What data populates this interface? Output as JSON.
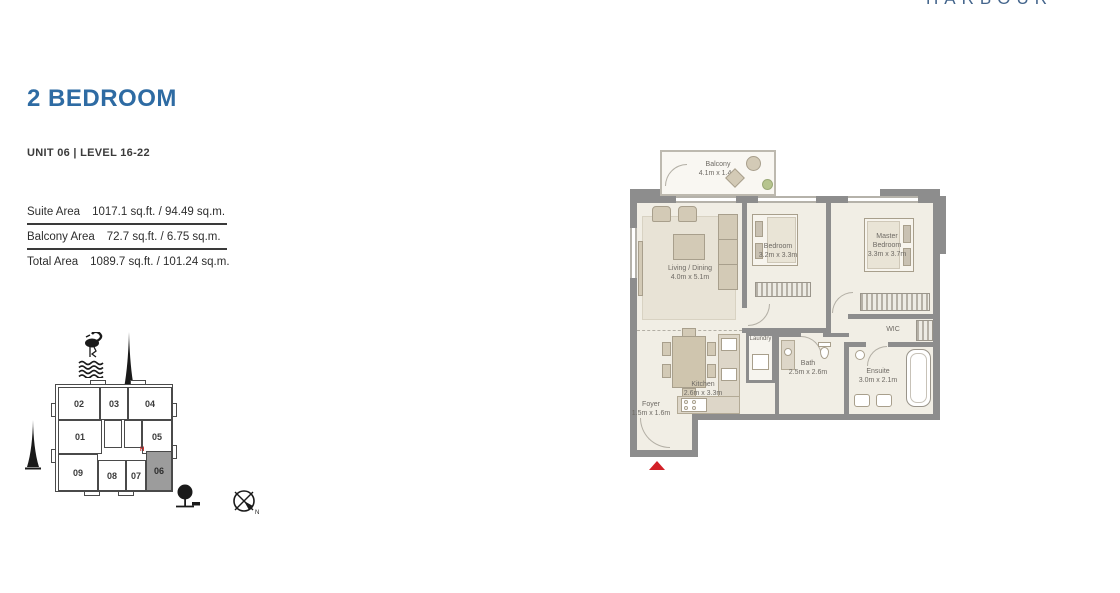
{
  "brand": {
    "wordmark": "HARBOUR"
  },
  "header": {
    "title": "2 BEDROOM",
    "unit_line": "UNIT 06 | LEVEL 16-22"
  },
  "areas": {
    "rows": [
      {
        "label": "Suite Area",
        "value": "1017.1 sq.ft. / 94.49 sq.m."
      },
      {
        "label": "Balcony Area",
        "value": "72.7 sq.ft. / 6.75 sq.m."
      },
      {
        "label": "Total Area",
        "value": "1089.7 sq.ft. / 101.24 sq.m."
      }
    ]
  },
  "keyplan": {
    "units": [
      "01",
      "02",
      "03",
      "04",
      "05",
      "06",
      "07",
      "08",
      "09"
    ],
    "highlighted_unit": "06",
    "marker_label": "H",
    "compass_label": "N"
  },
  "floorplan": {
    "rooms": [
      {
        "name": "Balcony",
        "dims": "4.1m x 1.4m"
      },
      {
        "name": "Living / Dining",
        "dims": "4.0m x 5.1m"
      },
      {
        "name": "Bedroom",
        "dims": "3.2m x 3.3m"
      },
      {
        "name": "Master Bedroom",
        "dims": "3.3m x 3.7m"
      },
      {
        "name": "WIC"
      },
      {
        "name": "Laundry"
      },
      {
        "name": "Bath",
        "dims": "2.5m x 2.6m"
      },
      {
        "name": "Ensuite",
        "dims": "3.0m x 2.1m"
      },
      {
        "name": "Kitchen",
        "dims": "2.6m x 3.3m"
      },
      {
        "name": "Foyer",
        "dims": "1.5m x 1.6m"
      }
    ]
  },
  "colors": {
    "accent_blue": "#2e6ba3",
    "wall_gray": "#8d8d8d",
    "floor_beige": "#f1eee5",
    "highlight_gray": "#9c9c9c",
    "entry_red": "#d22027"
  }
}
